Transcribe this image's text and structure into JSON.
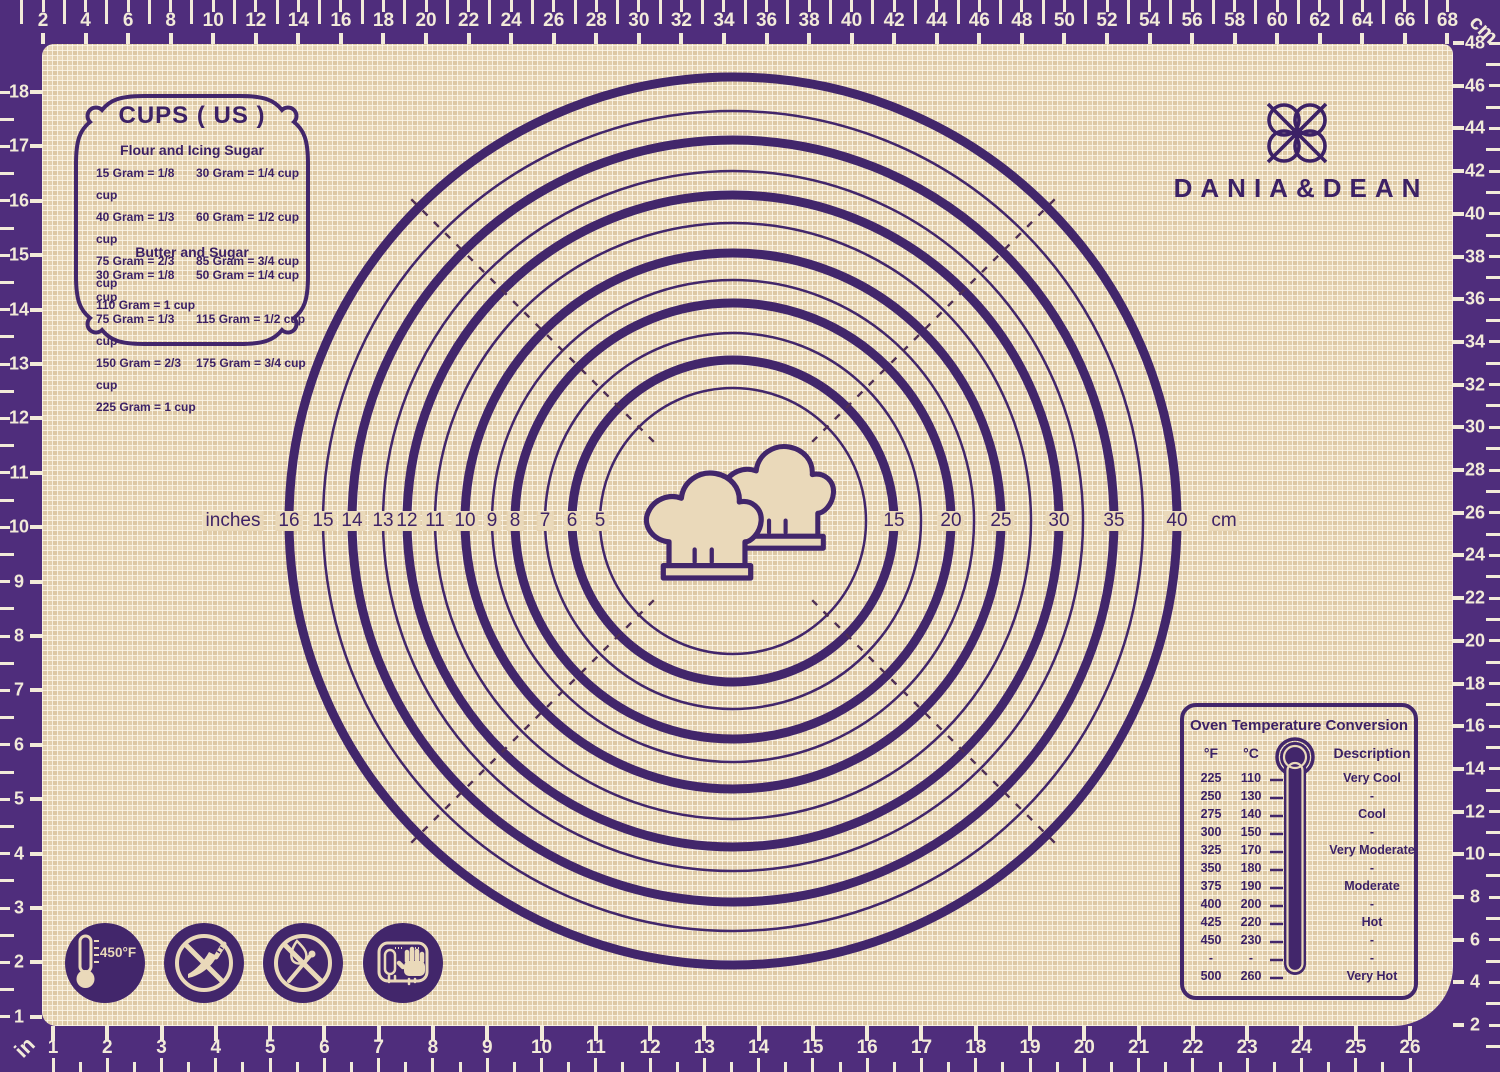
{
  "product": {
    "brand": "DANIA&DEAN"
  },
  "icons_legend": {
    "logo": "knot-flower-icon",
    "center": "chef-hats-icon",
    "oven": "thermometer-icon"
  },
  "cups_box": {
    "title": "CUPS ( US )",
    "sections": [
      {
        "heading": "Flour and Icing Sugar",
        "left": [
          "15 Gram = 1/8 cup",
          "40 Gram = 1/3 cup",
          "75 Gram = 2/3 cup",
          "110 Gram =   1 cup"
        ],
        "right": [
          "30 Gram = 1/4 cup",
          "60 Gram = 1/2 cup",
          "85 Gram = 3/4 cup"
        ]
      },
      {
        "heading": "Butter and Sugar",
        "left": [
          "30 Gram = 1/8 cup",
          "75 Gram = 1/3 cup",
          "150 Gram = 2/3 cup",
          "225 Gram =   1 cup"
        ],
        "right": [
          "50 Gram = 1/4 cup",
          "115 Gram = 1/2 cup",
          "175 Gram = 3/4 cup"
        ]
      }
    ]
  },
  "oven_box": {
    "title": "Oven Temperature Conversion",
    "headers": {
      "f": "°F",
      "c": "°C",
      "desc": "Description"
    },
    "rows": [
      {
        "f": "225",
        "c": "110",
        "desc": "Very Cool"
      },
      {
        "f": "250",
        "c": "130",
        "desc": "-"
      },
      {
        "f": "275",
        "c": "140",
        "desc": "Cool"
      },
      {
        "f": "300",
        "c": "150",
        "desc": "-"
      },
      {
        "f": "325",
        "c": "170",
        "desc": "Very Moderate"
      },
      {
        "f": "350",
        "c": "180",
        "desc": "-"
      },
      {
        "f": "375",
        "c": "190",
        "desc": "Moderate"
      },
      {
        "f": "400",
        "c": "200",
        "desc": "-"
      },
      {
        "f": "425",
        "c": "220",
        "desc": "Hot"
      },
      {
        "f": "450",
        "c": "230",
        "desc": "-"
      },
      {
        "f": "-",
        "c": "-",
        "desc": "-"
      },
      {
        "f": "500",
        "c": "260",
        "desc": "Very Hot"
      }
    ]
  },
  "rulers": {
    "top_cm": {
      "unit": "cm",
      "values": [
        2,
        4,
        6,
        8,
        10,
        12,
        14,
        16,
        18,
        20,
        22,
        24,
        26,
        28,
        30,
        32,
        34,
        36,
        38,
        40,
        42,
        44,
        46,
        48,
        50,
        52,
        54,
        56,
        58,
        60,
        62,
        64,
        66,
        68
      ]
    },
    "right_cm": {
      "values": [
        48,
        46,
        44,
        42,
        40,
        38,
        36,
        34,
        32,
        30,
        28,
        26,
        24,
        22,
        20,
        18,
        16,
        14,
        12,
        10,
        8,
        6,
        4,
        2
      ]
    },
    "left_in": {
      "values": [
        18,
        17,
        16,
        15,
        14,
        13,
        12,
        11,
        10,
        9,
        8,
        7,
        6,
        5,
        4,
        3,
        2,
        1
      ]
    },
    "bottom_in": {
      "unit": "in",
      "values": [
        1,
        2,
        3,
        4,
        5,
        6,
        7,
        8,
        9,
        10,
        11,
        12,
        13,
        14,
        15,
        16,
        17,
        18,
        19,
        20,
        21,
        22,
        23,
        24,
        25,
        26
      ]
    }
  },
  "circle_guide": {
    "left_unit_label": "inches",
    "right_unit_label": "cm",
    "rings": [
      {
        "inches": "16",
        "cm": "40",
        "thick": true
      },
      {
        "inches": "15",
        "thick": false
      },
      {
        "inches": "14",
        "cm": "35",
        "thick": true
      },
      {
        "inches": "13",
        "thick": false
      },
      {
        "inches": "12",
        "cm": "30",
        "thick": true
      },
      {
        "inches": "11",
        "thick": false
      },
      {
        "inches": "10",
        "cm": "25",
        "thick": true
      },
      {
        "inches": "9",
        "thick": false
      },
      {
        "inches": "8",
        "cm": "20",
        "thick": true
      },
      {
        "inches": "7",
        "thick": false
      },
      {
        "inches": "6",
        "cm": "15",
        "thick": true
      },
      {
        "inches": "5",
        "thick": false
      }
    ]
  },
  "safety_icons": [
    {
      "name": "max-temperature",
      "label": "450°F"
    },
    {
      "name": "no-knife"
    },
    {
      "name": "no-flame"
    },
    {
      "name": "hand-wash"
    }
  ],
  "colors": {
    "band_purple": "#4f2d7c",
    "line_purple": "#42266b",
    "mat_beige": "#ead9ba",
    "cream": "#f2ead9",
    "dash": "#4f2f55",
    "text_purple": "#3c2166"
  }
}
